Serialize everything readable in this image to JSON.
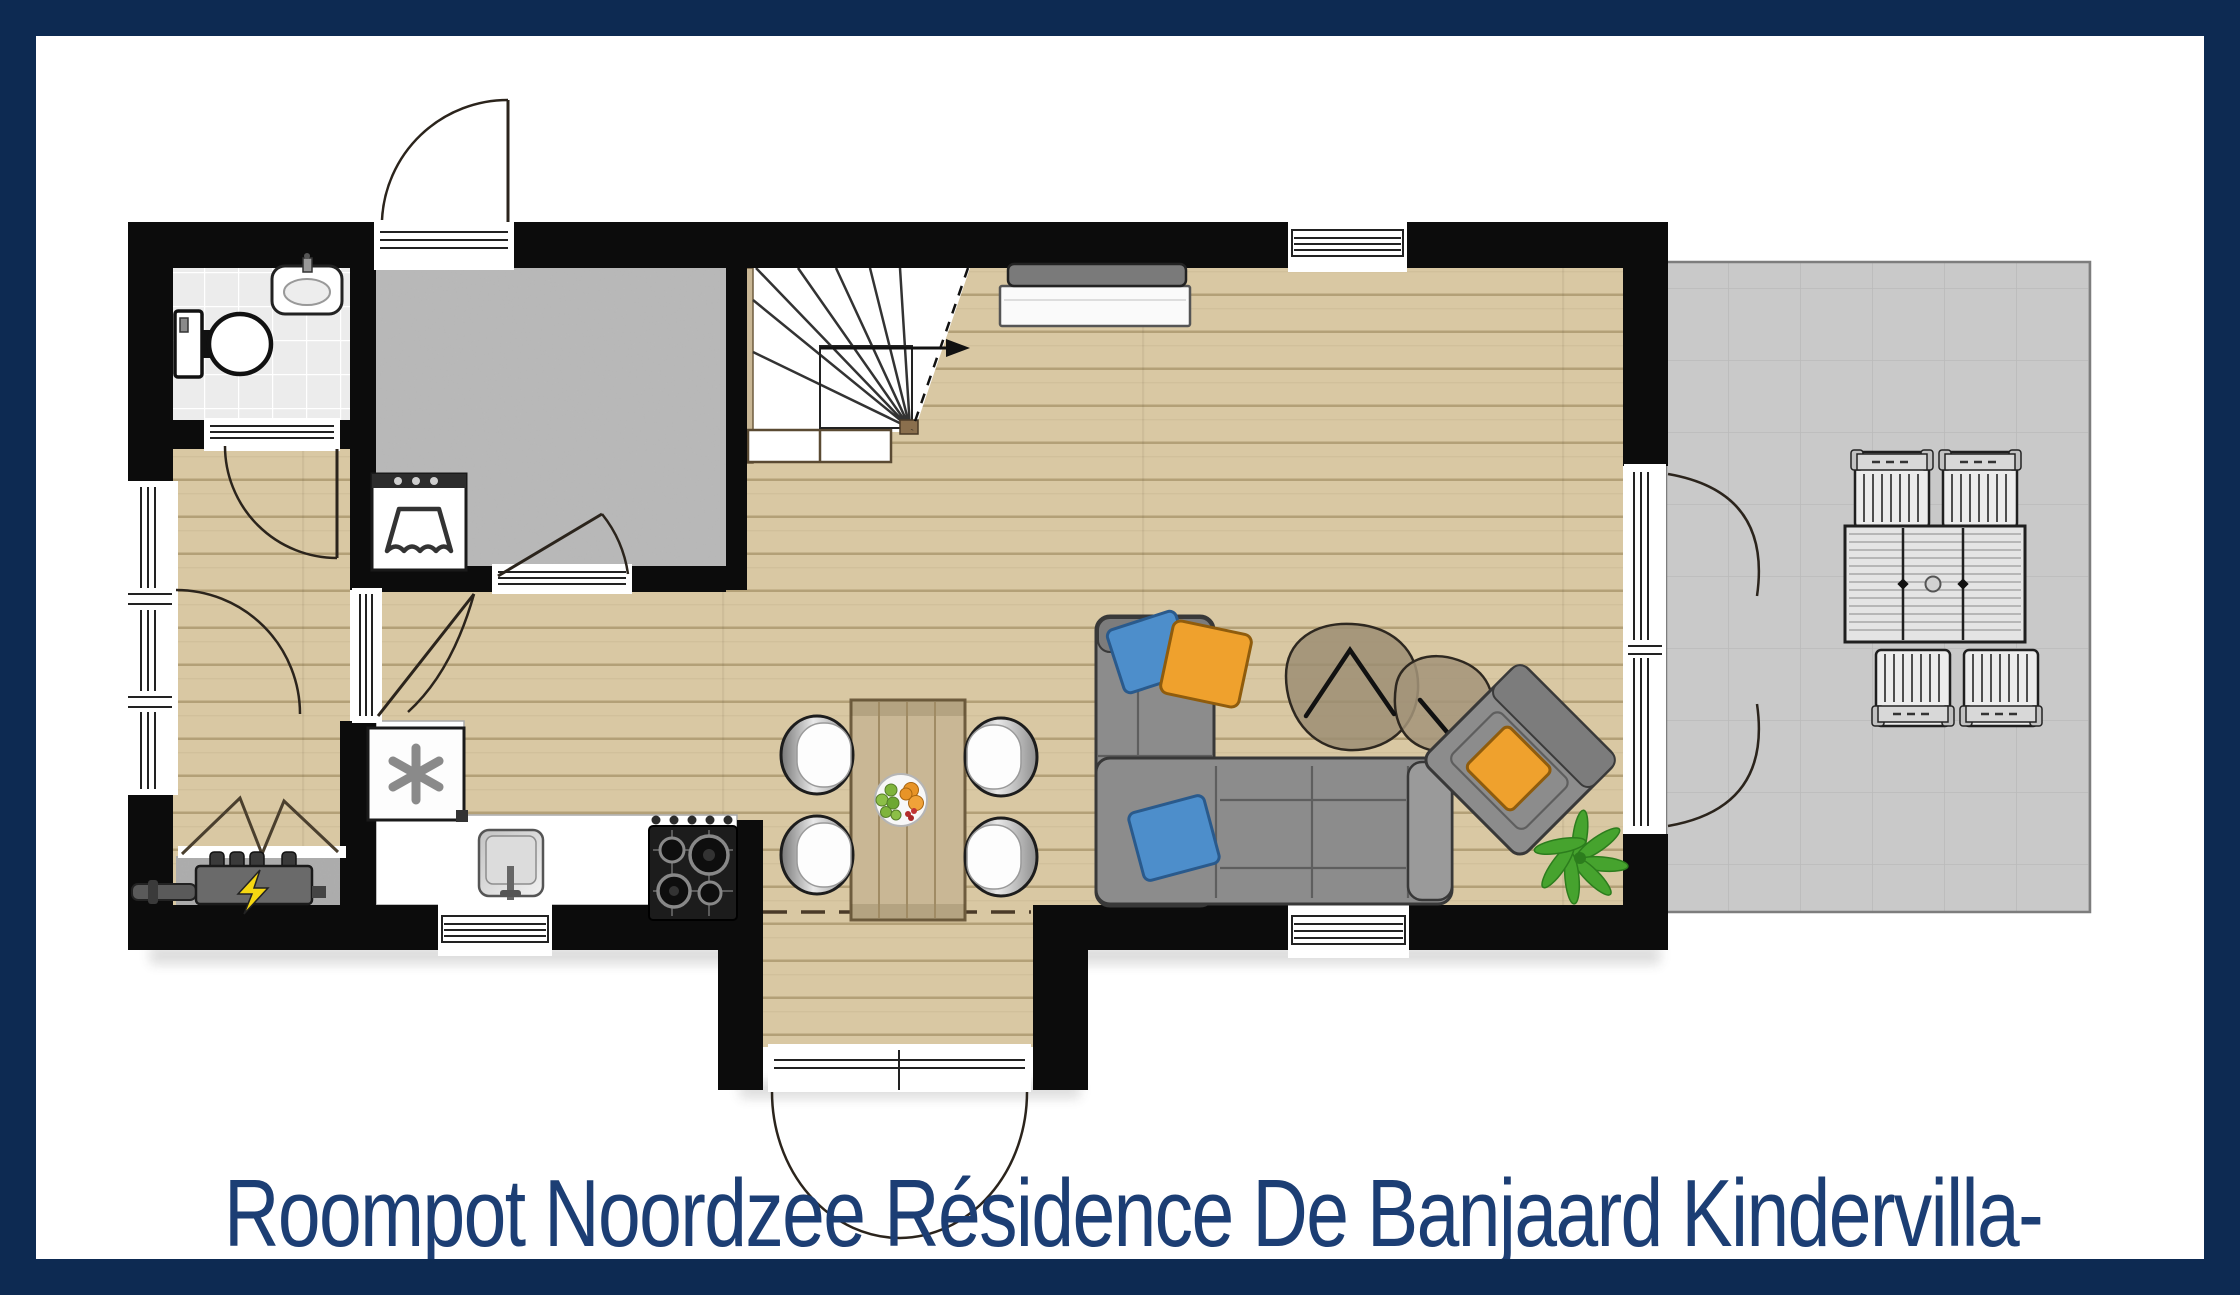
{
  "caption": {
    "text": "Roompot Noordzee Résidence De Banjaard Kindervilla-"
  },
  "colors": {
    "border_navy": "#0d2a52",
    "caption_navy": "#1c3e74",
    "wall_black": "#0c0c0c",
    "wood_floor": "#d9c8a3",
    "wood_line": "#b3a077",
    "gray_room_floor": "#b9b9b9",
    "terrace_gray": "#c9c9c9",
    "terrace_line": "#bababa",
    "bath_tile": "#ececec",
    "sofa_gray": "#8c8c8c",
    "pillow_blue": "#4d8ecb",
    "pillow_orange": "#efa12d",
    "plant_green": "#46a32e",
    "table_wood": "#c9b795",
    "bolt_yellow": "#f5d712"
  },
  "floor_plan": {
    "rooms": [
      "bathroom",
      "storage-room",
      "hallway",
      "technical-closet",
      "kitchen",
      "dining-area",
      "living-room",
      "entrance-vestibule",
      "staircase",
      "terrace"
    ],
    "fixtures": [
      "toilet",
      "hand-basin",
      "washing-machine",
      "freezer",
      "central-heating-unit",
      "kitchen-sink",
      "gas-hob",
      "kitchen-counter"
    ],
    "furniture": [
      "dining-table",
      "four-dining-chairs",
      "fruit-bowl",
      "corner-sofa",
      "three-cushions",
      "two-coffee-tables",
      "armchair-with-cushion",
      "plant",
      "tv-cabinet",
      "terrace-table",
      "four-terrace-chairs"
    ],
    "openings": [
      "front-double-door",
      "storage-exterior-door",
      "terrace-french-doors",
      "hall-side-door",
      "bathroom-door",
      "storage-door",
      "hall-living-door",
      "five-windows"
    ]
  }
}
